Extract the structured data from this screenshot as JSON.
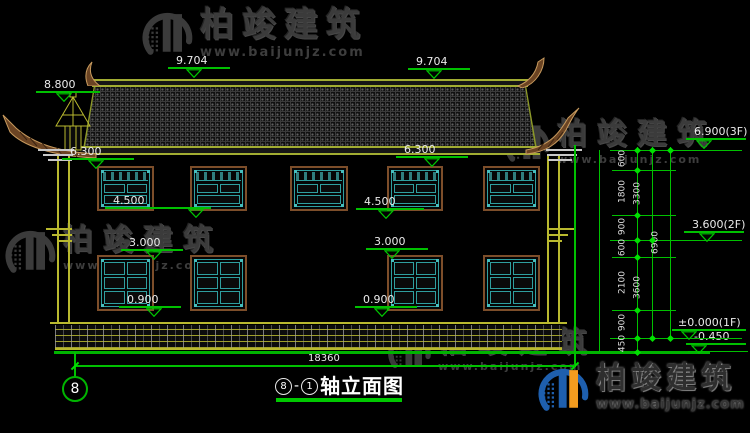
{
  "watermark": {
    "brand": "柏竣建筑",
    "url": "www.baijunjz.com"
  },
  "drawing": {
    "title": {
      "left_axis": "8",
      "dash": "-",
      "right_axis": "1",
      "label": "轴立面图"
    },
    "axis_bubble": "8",
    "overall_width_dim": "18360",
    "elevation_marks": [
      {
        "label": "8.800",
        "tx": 44,
        "ty": 79,
        "lx": 36,
        "lw": 64,
        "trx": 56
      },
      {
        "label": "9.704",
        "tx": 176,
        "ty": 55,
        "lx": 168,
        "lw": 62,
        "trx": 186
      },
      {
        "label": "9.704",
        "tx": 416,
        "ty": 56,
        "lx": 408,
        "lw": 62,
        "trx": 426
      },
      {
        "label": "6.300",
        "tx": 70,
        "ty": 146,
        "lx": 62,
        "lw": 72,
        "trx": 88
      },
      {
        "label": "6.300",
        "tx": 404,
        "ty": 144,
        "lx": 396,
        "lw": 72,
        "trx": 424
      },
      {
        "label": "4.500",
        "tx": 113,
        "ty": 195,
        "lx": 105,
        "lw": 106,
        "trx": 188
      },
      {
        "label": "4.500",
        "tx": 364,
        "ty": 196,
        "lx": 356,
        "lw": 68,
        "trx": 378
      },
      {
        "label": "3.000",
        "tx": 129,
        "ty": 237,
        "lx": 121,
        "lw": 62,
        "trx": 146
      },
      {
        "label": "3.000",
        "tx": 374,
        "ty": 236,
        "lx": 366,
        "lw": 62,
        "trx": 384
      },
      {
        "label": "0.900",
        "tx": 127,
        "ty": 294,
        "lx": 119,
        "lw": 62,
        "trx": 146
      },
      {
        "label": "0.900",
        "tx": 363,
        "ty": 294,
        "lx": 355,
        "lw": 62,
        "trx": 374
      },
      {
        "label": "6.900(3F)",
        "tx": 694,
        "ty": 126,
        "lx": 686,
        "lw": 60,
        "trx": 696
      },
      {
        "label": "3.600(2F)",
        "tx": 692,
        "ty": 219,
        "lx": 684,
        "lw": 60,
        "trx": 699
      },
      {
        "label": "±0.000(1F)",
        "tx": 678,
        "ty": 317,
        "lx": 672,
        "lw": 74,
        "trx": 681
      },
      {
        "label": "-0.450",
        "tx": 694,
        "ty": 331,
        "lx": 686,
        "lw": 60,
        "trx": 691
      }
    ],
    "right_dim_chain": {
      "verticals": [
        {
          "x": 637,
          "y1": 147,
          "y2": 352
        },
        {
          "x": 652,
          "y1": 147,
          "y2": 338
        },
        {
          "x": 670,
          "y1": 147,
          "y2": 338
        },
        {
          "x": 599,
          "y1": 150,
          "y2": 352
        },
        {
          "x": 574,
          "y1": 145,
          "y2": 367
        }
      ],
      "level_lines": [
        {
          "y": 150,
          "x1": 610,
          "x2": 742
        },
        {
          "y": 170,
          "x1": 612,
          "x2": 676
        },
        {
          "y": 215,
          "x1": 612,
          "x2": 676
        },
        {
          "y": 240,
          "x1": 610,
          "x2": 742
        },
        {
          "y": 257,
          "x1": 612,
          "x2": 676
        },
        {
          "y": 310,
          "x1": 612,
          "x2": 676
        },
        {
          "y": 338,
          "x1": 610,
          "x2": 742
        },
        {
          "y": 351,
          "x1": 688,
          "x2": 748
        }
      ],
      "columns": [
        {
          "x": 637,
          "segments": [
            {
              "label": "600",
              "from": 150,
              "to": 170
            },
            {
              "label": "1800",
              "from": 170,
              "to": 215
            },
            {
              "label": "900",
              "from": 215,
              "to": 240
            },
            {
              "label": "600",
              "from": 240,
              "to": 257
            },
            {
              "label": "2100",
              "from": 257,
              "to": 310
            },
            {
              "label": "900",
              "from": 310,
              "to": 338
            },
            {
              "label": "450",
              "from": 338,
              "to": 352
            }
          ]
        },
        {
          "x": 652,
          "segments": [
            {
              "label": "3300",
              "from": 150,
              "to": 240
            },
            {
              "label": "3600",
              "from": 240,
              "to": 338
            }
          ]
        },
        {
          "x": 670,
          "segments": [
            {
              "label": "6900",
              "from": 150,
              "to": 338
            }
          ]
        }
      ],
      "diamonds": [
        {
          "x": 637,
          "ys": [
            150,
            170,
            215,
            240,
            257,
            310,
            338,
            352
          ]
        },
        {
          "x": 652,
          "ys": [
            150,
            240,
            338
          ]
        },
        {
          "x": 670,
          "ys": [
            150,
            338
          ]
        }
      ]
    },
    "windows": {
      "upper": {
        "y": 166,
        "h": 45,
        "items": [
          {
            "x": 97,
            "w": 57
          },
          {
            "x": 190,
            "w": 57
          },
          {
            "x": 290,
            "w": 58
          },
          {
            "x": 387,
            "w": 56
          },
          {
            "x": 483,
            "w": 57
          }
        ]
      },
      "lower": {
        "y": 255,
        "h": 56,
        "items": [
          {
            "x": 97,
            "w": 57
          },
          {
            "x": 190,
            "w": 57
          },
          {
            "x": 387,
            "w": 56
          },
          {
            "x": 483,
            "w": 57
          }
        ]
      }
    },
    "overall_dim_line": {
      "y": 365,
      "x1": 75,
      "x2": 575
    }
  },
  "watermark_instances": [
    {
      "style": "gray",
      "x": 140,
      "y": 8,
      "logo": 56,
      "brand_size": 34,
      "brand_spacing": 8,
      "url_size": 13
    },
    {
      "style": "gray",
      "x": 503,
      "y": 120,
      "logo": 50,
      "brand_size": 30,
      "brand_spacing": 10,
      "url_size": 11
    },
    {
      "style": "gray",
      "x": 3,
      "y": 226,
      "logo": 56,
      "brand_size": 30,
      "brand_spacing": 10,
      "url_size": 11
    },
    {
      "style": "gray",
      "x": 386,
      "y": 328,
      "logo": 48,
      "brand_size": 29,
      "brand_spacing": 11,
      "url_size": 11
    },
    {
      "style": "color",
      "x": 536,
      "y": 364,
      "logo": 56,
      "brand_size": 30,
      "brand_spacing": 5,
      "url_size": 13
    }
  ],
  "colors": {
    "background": "#000000",
    "cad_yellow": "#b9b92f",
    "roof_olive": "#a2ad32",
    "cad_green": "#00c000",
    "dim_text": "#eaeaea",
    "window_teal": "#2f9f9f",
    "window_frame_brown": "#7d4e2a",
    "ornament_brown": "#6b4423",
    "ornament_stroke": "#c79a5e",
    "watermark_gray": "#3b3b3b",
    "logo_blue": "#1e5fae",
    "logo_orange": "#f39c1f"
  }
}
